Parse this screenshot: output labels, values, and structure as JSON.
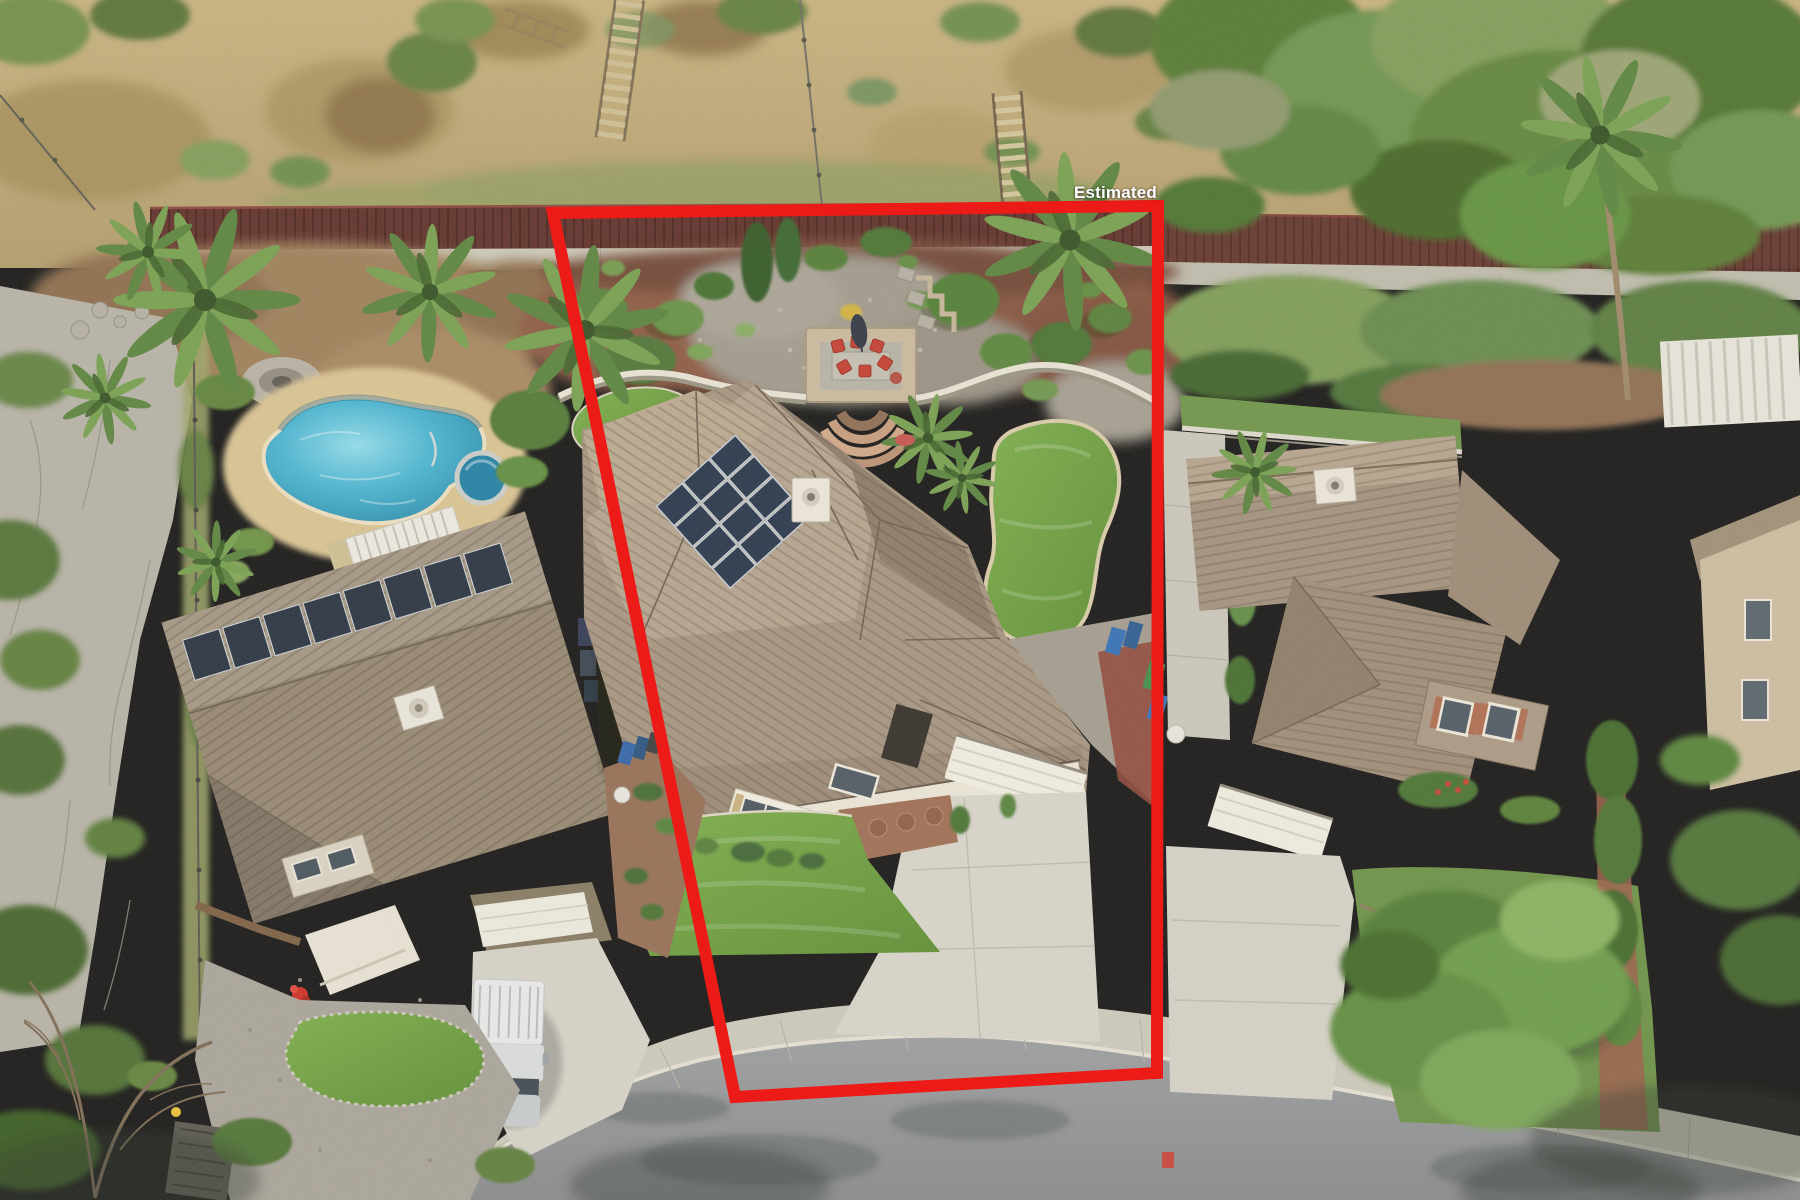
{
  "window": {
    "width": 1800,
    "height": 1200
  },
  "overlay": {
    "label": "Estimated",
    "label_color": "#ffffff",
    "boundary_color": "#ed1b17",
    "boundary_stroke_width": 12,
    "boundary_points": "553,213 1158,206 1157,1073 735,1097"
  },
  "scene": {
    "type": "aerial-photo",
    "description": "Drone aerial of a suburban cul-de-sac: center lot outlined in red (Estimated boundary) with tan tile-roof house, rooftop solar, red-chair patio, turf lawns; left neighbor with kidney pool, spa and white pickup; right neighbor with large front tree; dry hillside and maroon fence along the back; gray street at bottom.",
    "palette": {
      "dry_hillside": "#bfa878",
      "fence_maroon": "#5c2c26",
      "concrete": "#cdcaba",
      "asphalt": "#8f9193",
      "mulch": "#82503a",
      "river_rock": "#9e988b",
      "turf": "#66a03a",
      "natural_lawn": "#688f42",
      "pool_water": "#35a3c4",
      "roof_subject": "#a3927e",
      "roof_left": "#93856f",
      "roof_right": "#a08f7b",
      "foliage_dark": "#3f6626",
      "foliage_light": "#6e9a48",
      "solar_panel": "#233247",
      "truck_white": "#e8eaea",
      "patio_chair_red": "#c33a2c"
    }
  }
}
